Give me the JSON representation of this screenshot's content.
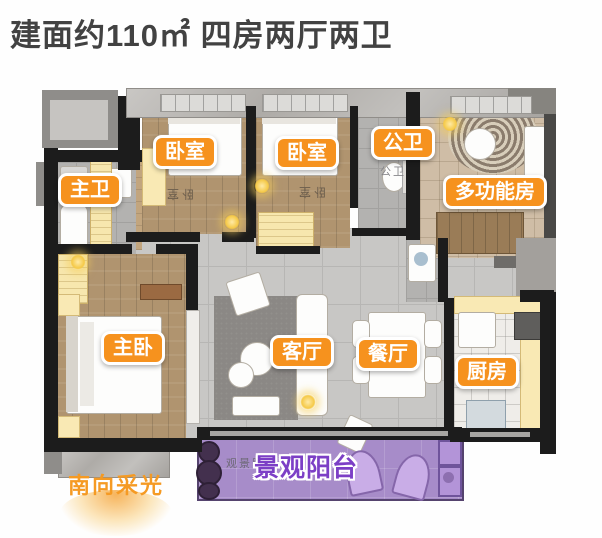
{
  "title": {
    "text": "建面约110㎡ 四房两厅两卫"
  },
  "room_labels": [
    {
      "id": "master-bath",
      "text": "主卫"
    },
    {
      "id": "bedroom-1",
      "text": "卧室"
    },
    {
      "id": "bedroom-2",
      "text": "卧室"
    },
    {
      "id": "public-bath",
      "text": "公卫"
    },
    {
      "id": "multi-function-room",
      "text": "多功能房"
    },
    {
      "id": "master-bedroom",
      "text": "主卧"
    },
    {
      "id": "living-room",
      "text": "客厅"
    },
    {
      "id": "dining-room",
      "text": "餐厅"
    },
    {
      "id": "kitchen",
      "text": "厨房"
    }
  ],
  "plan_texts": {
    "bedroom_1_floor": "卧室",
    "bedroom_2_floor": "卧室",
    "public_bath_floor": "公卫",
    "balcony_floor": "观景阳台"
  },
  "balcony": {
    "label": "景观阳台"
  },
  "annotations": {
    "south_light": "南向采光"
  },
  "colors": {
    "label_orange": "#f6921e",
    "balcony_purple": "#a78cc9",
    "balcony_label_purple": "#7c3fc6",
    "south_light_orange": "#f59a23",
    "wall_dark": "#1c1c1c",
    "wood_floor": "#b0946f",
    "tile_gray": "#c8c7c5"
  }
}
